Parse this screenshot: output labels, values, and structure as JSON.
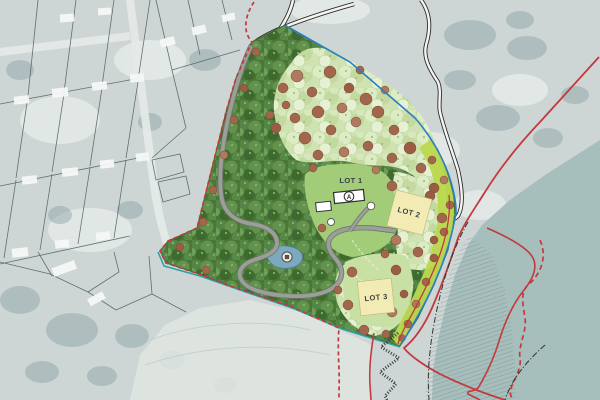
{
  "site_plan": {
    "description": "Landscape subdivision site plan over faded aerial photograph with coastal estuary",
    "lots": [
      {
        "id": "lot-1",
        "label": "LOT 1"
      },
      {
        "id": "lot-2",
        "label": "LOT 2"
      },
      {
        "id": "lot-3",
        "label": "LOT 3"
      }
    ],
    "markers": {
      "building_a": "A"
    },
    "colors": {
      "aerial_base": "#cdd6d5",
      "water": "#a6bebc",
      "sand_flats": "#dfe5e1",
      "forest_dark": "#4a7738",
      "forest_mid": "#62924d",
      "canopy_light": "#cfe2b2",
      "tree_redbrown": "#a2664d",
      "lawn": "#a3cc78",
      "paddock": "#c8e0a4",
      "lime_strip": "#bcd84e",
      "lot_fill": "#f2ecb4",
      "building_fill": "#ffffff",
      "pond": "#7ca9be",
      "boundary_red": "#c23a3e",
      "boundary_blue": "#2b7fc2",
      "boundary_teal": "#2ba0a8",
      "road_casing": "#2d2d2d",
      "driveway_grey": "#9aa097",
      "cadastral_line": "#4b5c60",
      "shoreline_dashdot": "#333333"
    }
  }
}
